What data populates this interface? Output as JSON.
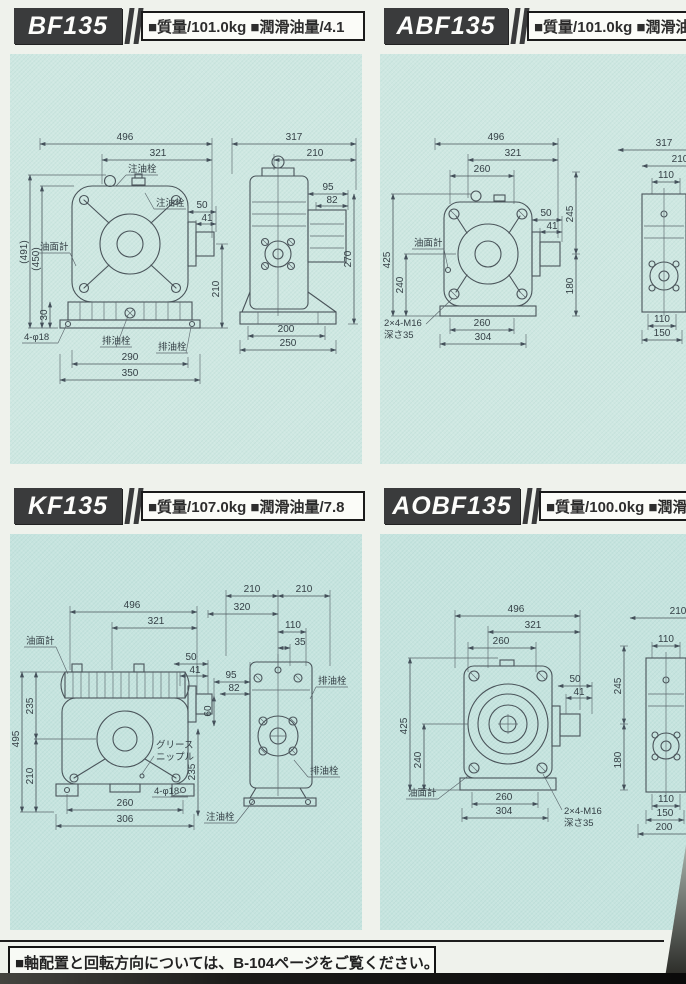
{
  "page": {
    "panel_bg": "#cfe8e2",
    "accent_dark": "#3a3b3c"
  },
  "panels": {
    "bf": {
      "model": "BF135",
      "spec": "■質量/101.0kg ■潤滑油量/4.1",
      "f": {
        "d496": "496",
        "d321": "321",
        "d491": "(491)",
        "d450": "(450)",
        "d30": "30",
        "d290": "290",
        "d350": "350",
        "d210": "210",
        "d50": "50",
        "d41": "41",
        "fill_top": "注油栓",
        "fill_side": "注油栓",
        "gauge": "油面計",
        "holes": "4-φ18",
        "drain1": "排油栓",
        "drain2": "排油栓"
      },
      "s": {
        "d317": "317",
        "d210": "210",
        "d95": "95",
        "d82": "82",
        "d270": "270",
        "d200": "200",
        "d250": "250"
      }
    },
    "abf": {
      "model": "ABF135",
      "spec": "■質量/101.0kg ■潤滑油量",
      "f": {
        "d496": "496",
        "d321": "321",
        "d260": "260",
        "d425": "425",
        "d240": "240",
        "d50": "50",
        "d41": "41",
        "d245": "245",
        "d180": "180",
        "d260b": "260",
        "d304": "304",
        "gauge": "油面計",
        "tap1": "2×4-M16",
        "tap2": "深さ35"
      },
      "s": {
        "d317": "317",
        "d210": "210",
        "d110": "110",
        "d110b": "110",
        "d150": "150"
      }
    },
    "kf": {
      "model": "KF135",
      "spec": "■質量/107.0kg ■潤滑油量/7.8",
      "f": {
        "d496": "496",
        "d321": "321",
        "d495": "495",
        "d235": "235",
        "d210": "210",
        "d50": "50",
        "d41": "41",
        "d60": "60",
        "d235b": "235",
        "d260": "260",
        "d306": "306",
        "gauge": "油面計",
        "grease1": "グリース",
        "grease2": "ニップル",
        "holes": "4-φ18"
      },
      "s": {
        "d210l": "210",
        "d210r": "210",
        "d320": "320",
        "d110": "110",
        "d35": "35",
        "d95": "95",
        "d82": "82",
        "drain_top": "排油栓",
        "fill": "注油栓",
        "drain_bot": "排油栓"
      }
    },
    "aobf": {
      "model": "AOBF135",
      "spec": "■質量/100.0kg ■潤滑油量",
      "f": {
        "d496": "496",
        "d321": "321",
        "d260": "260",
        "d425": "425",
        "d240": "240",
        "d50": "50",
        "d41": "41",
        "d245": "245",
        "d180": "180",
        "d260b": "260",
        "d304": "304",
        "gauge": "油面計",
        "tap1": "2×4-M16",
        "tap2": "深さ35"
      },
      "s": {
        "d210": "210",
        "d110": "110",
        "d110b": "110",
        "d150": "150",
        "d200": "200"
      }
    }
  },
  "footer": {
    "note": "■軸配置と回転方向については、B-104ページをご覧ください。"
  }
}
